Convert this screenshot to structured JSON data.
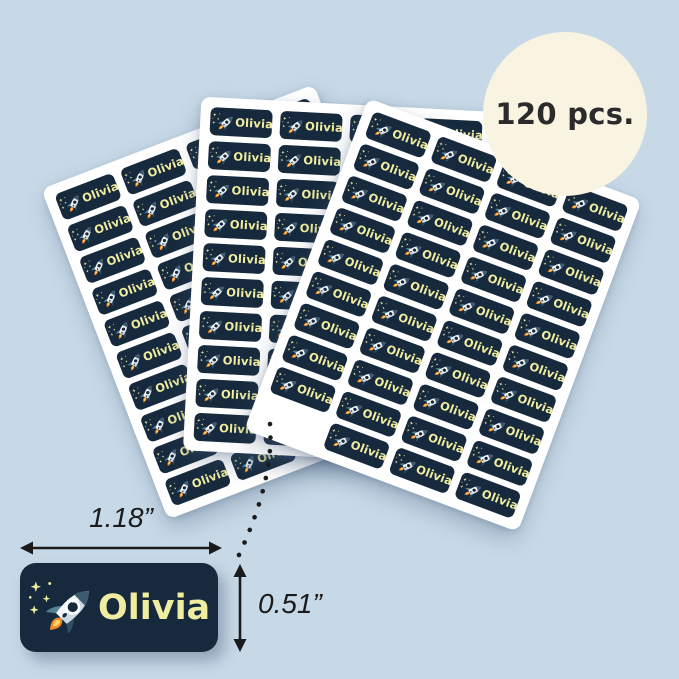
{
  "product": {
    "name_text": "Olivia",
    "pieces_badge": "120 pcs.",
    "width_label": "1.18”",
    "height_label": "0.51”",
    "sheet_count": 3,
    "labels_per_sheet": 40,
    "total_labels": 120
  },
  "sheets": [
    {
      "id": "left",
      "cols": 4,
      "rows": 10,
      "missing": null
    },
    {
      "id": "middle",
      "cols": 4,
      "rows": 10,
      "missing": null
    },
    {
      "id": "right",
      "cols": 4,
      "rows": 10,
      "missing": {
        "col": 0,
        "row": 9
      }
    }
  ],
  "icons": {
    "label_art": "rocket-with-stars-icon"
  },
  "colors": {
    "background": "#c7d9e7",
    "sheet": "#ffffff",
    "label_bg": "#172a3d",
    "label_text": "#f0eda0",
    "badge_bg": "#f9f4e2",
    "badge_text": "#2b2b2b",
    "annotation": "#1b1b1b",
    "flame_orange": "#f08a2e",
    "flame_yellow": "#ffd95e",
    "rocket_slate": "#3c5a70",
    "rocket_body": "#f2f6f8"
  }
}
